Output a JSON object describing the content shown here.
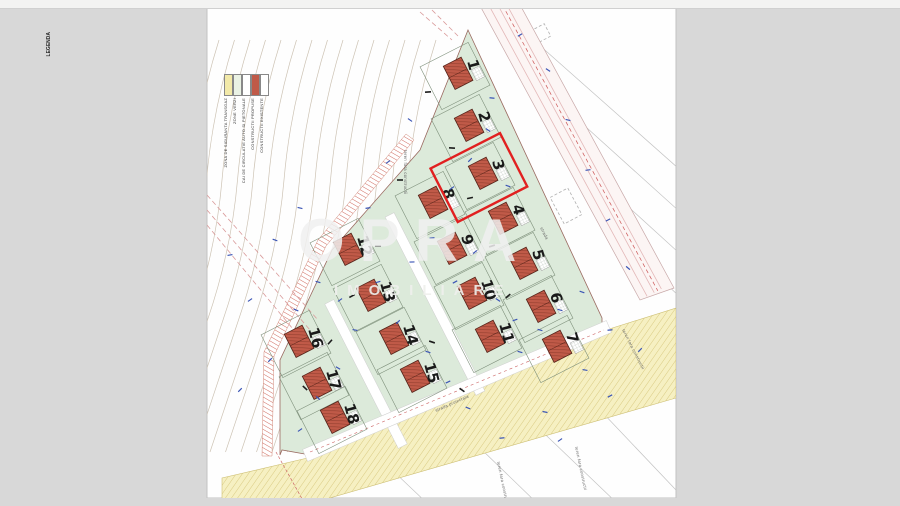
{
  "page": {
    "type": "scanned site plan",
    "bg": "#d8d8d8",
    "paper": "#ffffff"
  },
  "watermark": {
    "brand": "OPRA",
    "subtitle": "IMOBILIARE"
  },
  "legend": {
    "title": "LEGENDA",
    "items": [
      {
        "label": "CONSTRUCTII EXISTENTE",
        "color": "#ffffff"
      },
      {
        "label": "CONSTRUCTII PROPUSE",
        "color": "#c05a48"
      },
      {
        "label": "CAI DE CIRCULATIE AUTO SI PIETONALE",
        "color": "#ffffff"
      },
      {
        "label": "ZONE VERZI",
        "color": "#eaf2e4"
      },
      {
        "label": "ZONA DE SIGURANTA TRANSGAZ",
        "color": "#f2e9a8"
      }
    ]
  },
  "map": {
    "highlight_lot": "3",
    "lots": [
      {
        "n": "1",
        "x": 455,
        "y": 76
      },
      {
        "n": "2",
        "x": 466,
        "y": 128
      },
      {
        "n": "3",
        "x": 480,
        "y": 176
      },
      {
        "n": "4",
        "x": 500,
        "y": 221
      },
      {
        "n": "5",
        "x": 520,
        "y": 266
      },
      {
        "n": "6",
        "x": 538,
        "y": 309
      },
      {
        "n": "7",
        "x": 554,
        "y": 349
      },
      {
        "n": "8",
        "x": 430,
        "y": 205
      },
      {
        "n": "9",
        "x": 449,
        "y": 251
      },
      {
        "n": "10",
        "x": 469,
        "y": 296
      },
      {
        "n": "11",
        "x": 487,
        "y": 339
      },
      {
        "n": "12",
        "x": 345,
        "y": 252
      },
      {
        "n": "13",
        "x": 368,
        "y": 298
      },
      {
        "n": "14",
        "x": 391,
        "y": 341
      },
      {
        "n": "15",
        "x": 412,
        "y": 379
      },
      {
        "n": "16",
        "x": 296,
        "y": 344
      },
      {
        "n": "17",
        "x": 314,
        "y": 386
      },
      {
        "n": "18",
        "x": 332,
        "y": 420
      }
    ],
    "labels": [
      {
        "t": "teren fara constructii",
        "x": 404,
        "y": 150,
        "r": 90
      },
      {
        "t": "teren fara constructii",
        "x": 497,
        "y": 462,
        "r": 78
      },
      {
        "t": "teren fara constructii",
        "x": 575,
        "y": 447,
        "r": 78
      },
      {
        "t": "teren fara constructii",
        "x": 622,
        "y": 330,
        "r": 63
      },
      {
        "t": "strada proiectata",
        "x": 436,
        "y": 412,
        "r": -24
      },
      {
        "t": "strada",
        "x": 540,
        "y": 228,
        "r": 63
      }
    ],
    "blue_marks": [
      [
        492,
        98
      ],
      [
        488,
        130
      ],
      [
        470,
        160
      ],
      [
        508,
        186
      ],
      [
        452,
        188
      ],
      [
        432,
        238
      ],
      [
        412,
        262
      ],
      [
        455,
        282
      ],
      [
        475,
        252
      ],
      [
        498,
        300
      ],
      [
        515,
        320
      ],
      [
        378,
        282
      ],
      [
        398,
        322
      ],
      [
        355,
        330
      ],
      [
        338,
        368
      ],
      [
        318,
        398
      ],
      [
        300,
        430
      ],
      [
        428,
        352
      ],
      [
        448,
        382
      ],
      [
        468,
        408
      ],
      [
        520,
        352
      ],
      [
        540,
        330
      ],
      [
        560,
        310
      ],
      [
        582,
        292
      ],
      [
        610,
        330
      ],
      [
        585,
        370
      ],
      [
        545,
        412
      ],
      [
        502,
        438
      ],
      [
        560,
        440
      ],
      [
        610,
        396
      ],
      [
        640,
        350
      ],
      [
        296,
        310
      ],
      [
        318,
        282
      ],
      [
        340,
        300
      ],
      [
        250,
        300
      ],
      [
        230,
        255
      ],
      [
        270,
        360
      ],
      [
        240,
        390
      ],
      [
        410,
        120
      ],
      [
        388,
        162
      ],
      [
        368,
        208
      ],
      [
        300,
        208
      ],
      [
        275,
        240
      ],
      [
        548,
        70
      ],
      [
        568,
        120
      ],
      [
        588,
        170
      ],
      [
        608,
        220
      ],
      [
        628,
        268
      ],
      [
        520,
        35
      ]
    ],
    "black_marks": [
      [
        428,
        92
      ],
      [
        452,
        148
      ],
      [
        400,
        180
      ],
      [
        470,
        198
      ],
      [
        492,
        246
      ],
      [
        378,
        246
      ],
      [
        352,
        296
      ],
      [
        508,
        296
      ],
      [
        432,
        342
      ],
      [
        330,
        342
      ],
      [
        305,
        388
      ],
      [
        462,
        390
      ]
    ],
    "dashed_rects": [
      {
        "x": 572,
        "y": 138,
        "w": 20,
        "h": 40,
        "r": -28
      },
      {
        "x": 566,
        "y": 206,
        "w": 20,
        "h": 30,
        "r": -28
      },
      {
        "x": 640,
        "y": 270,
        "w": 18,
        "h": 26,
        "r": -28
      },
      {
        "x": 536,
        "y": 36,
        "w": 26,
        "h": 14,
        "r": -28
      }
    ],
    "neighbor_lines": [
      [
        520,
        28,
        678,
        168
      ],
      [
        556,
        100,
        700,
        230
      ],
      [
        590,
        172,
        700,
        272
      ],
      [
        622,
        242,
        700,
        316
      ],
      [
        420,
        390,
        540,
        506
      ],
      [
        480,
        372,
        620,
        506
      ],
      [
        545,
        352,
        676,
        490
      ],
      [
        350,
        430,
        430,
        506
      ]
    ],
    "pink_lines": [
      [
        207,
        195,
        318,
        320
      ],
      [
        207,
        210,
        310,
        330
      ],
      [
        207,
        225,
        302,
        340
      ],
      [
        420,
        12,
        452,
        40
      ],
      [
        432,
        10,
        458,
        36
      ]
    ],
    "colors": {
      "green": "#dceada",
      "lot_stroke": "#7d8f7a",
      "house": "#c05a48",
      "house_line": "#8f3d2d",
      "yellow": "#f6f0c2",
      "yellow_line": "#d9ca82",
      "highlight": "#e12020",
      "road_pink": "#e3b8b8",
      "contour": "#cdc3b4",
      "blue": "#3b55b5",
      "gray_line": "#c3c3c3",
      "red_hatch": "#d06a5e"
    }
  }
}
